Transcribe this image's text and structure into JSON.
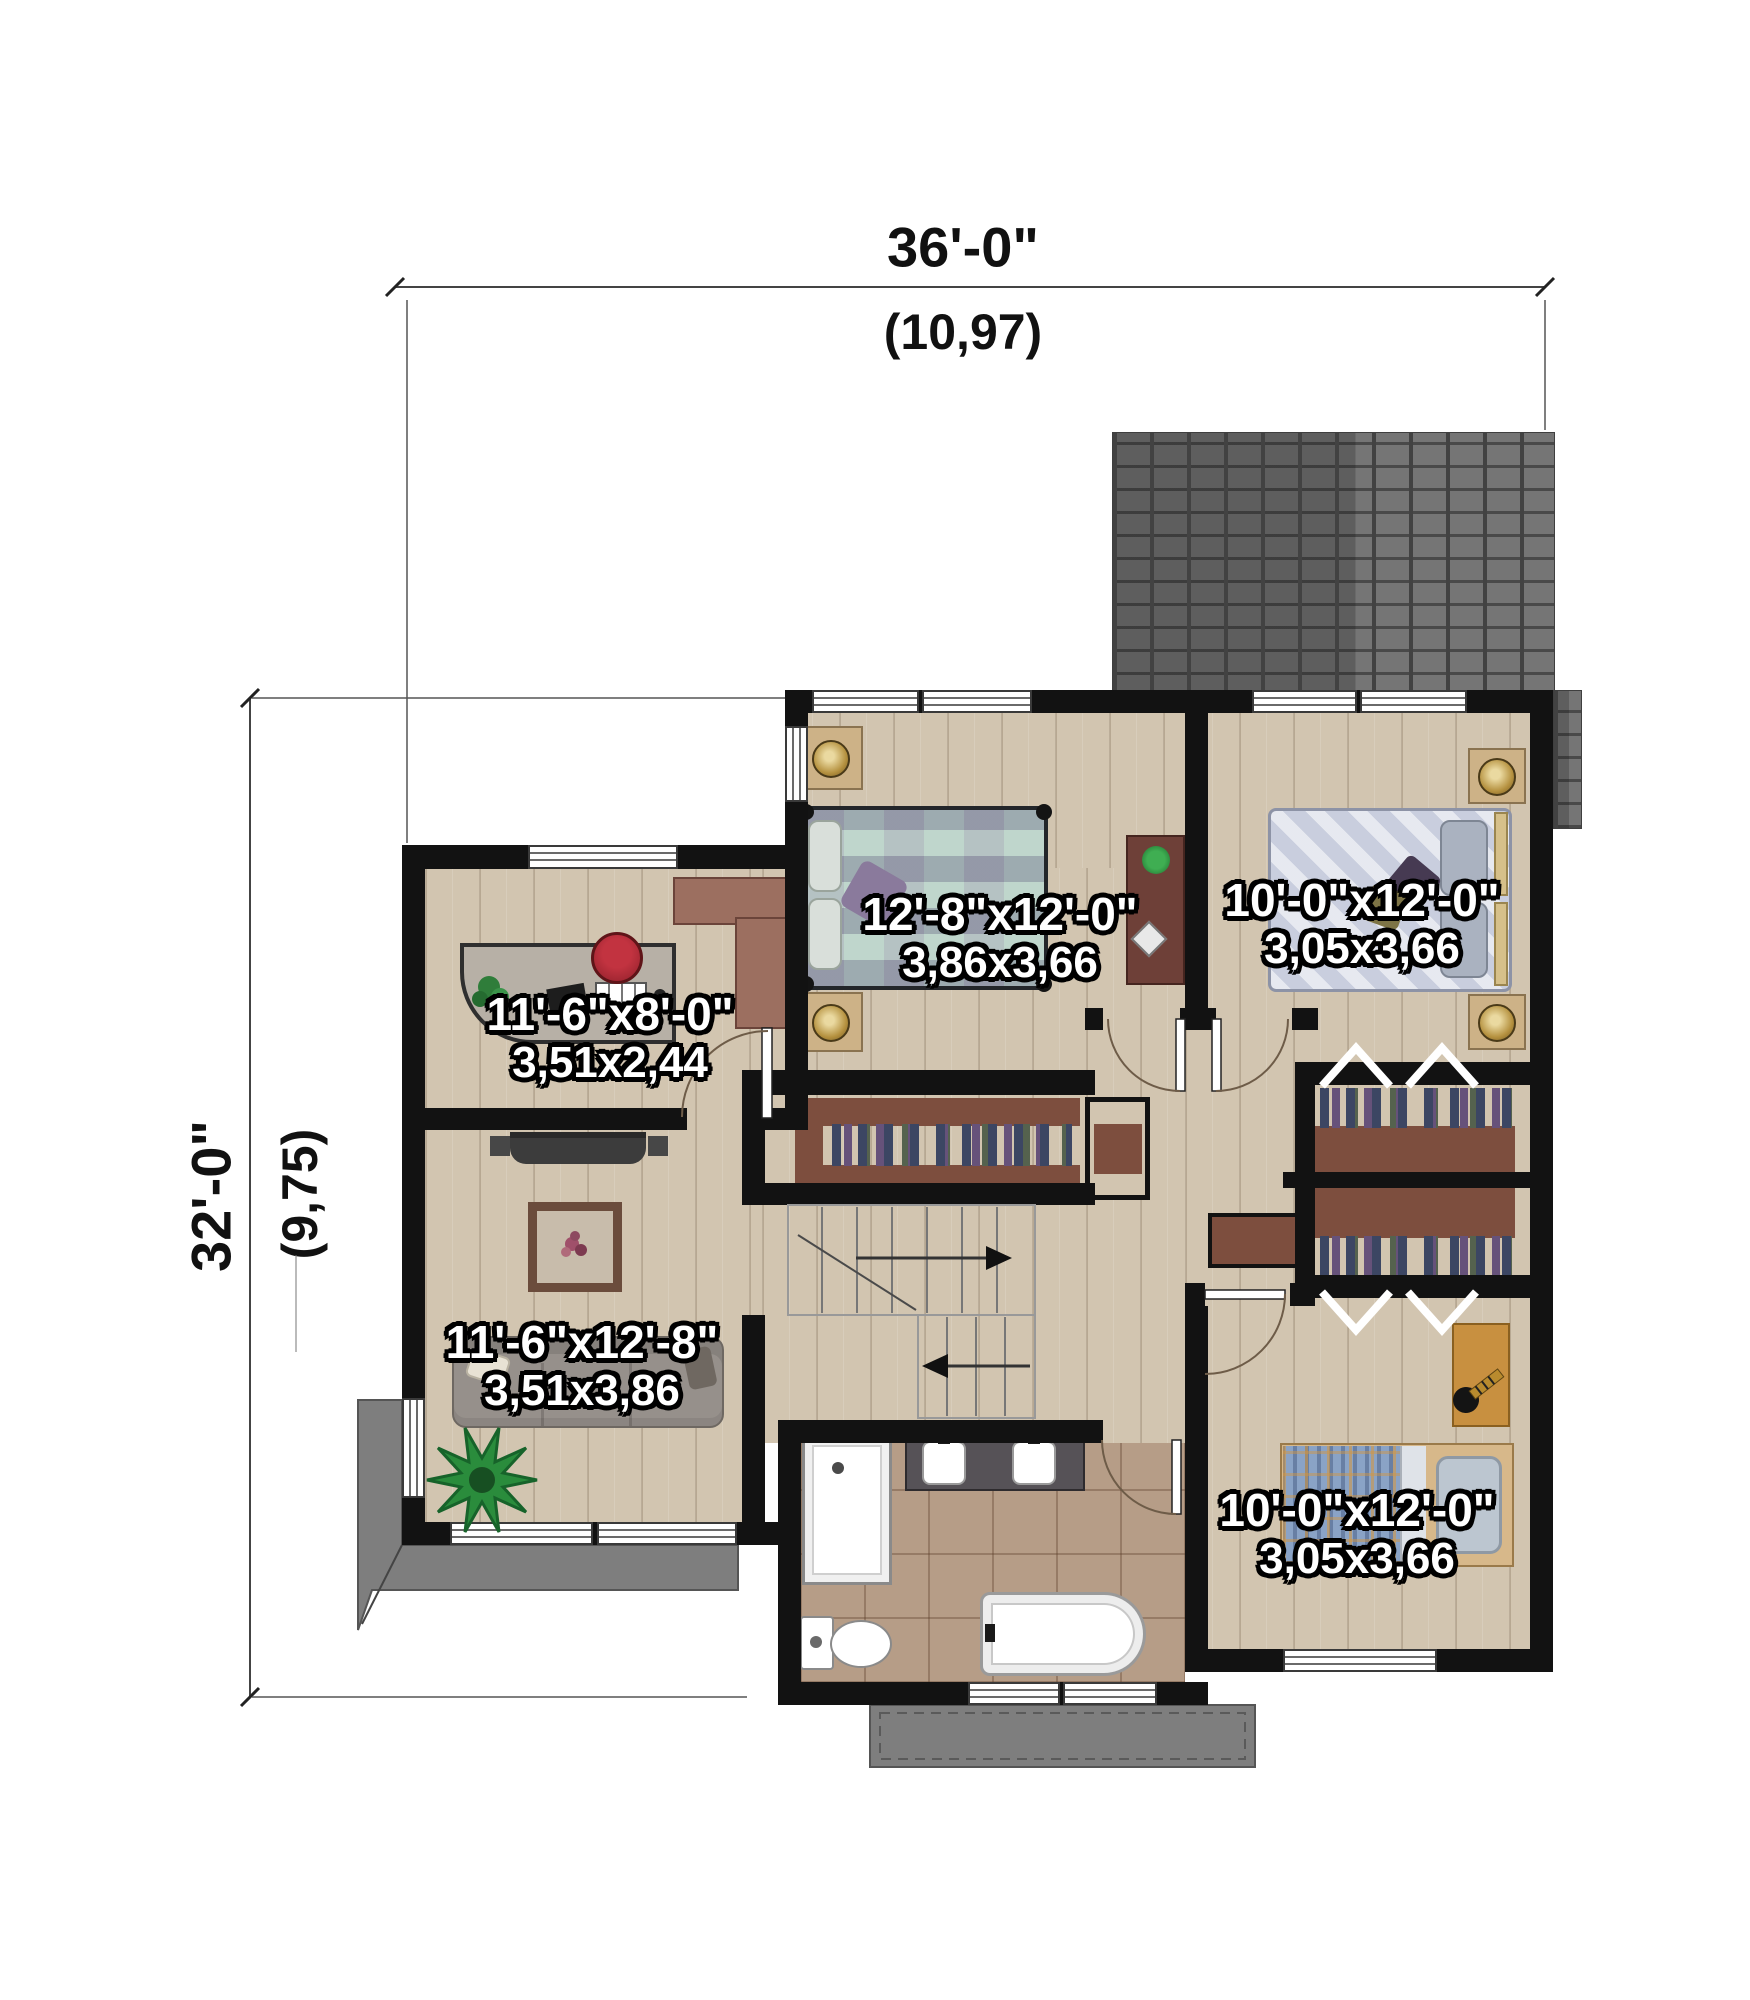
{
  "dimensions": {
    "top_feet": "36'-0\"",
    "top_meters": "(10,97)",
    "left_feet": "32'-0\"",
    "left_meters": "(9,75)"
  },
  "rooms": [
    {
      "name": "master-bedroom",
      "imperial": "12'-8\"x12'-0\"",
      "metric": "3,86x3,66"
    },
    {
      "name": "bedroom-top-right",
      "imperial": "10'-0\"x12'-0\"",
      "metric": "3,05x3,66"
    },
    {
      "name": "office-den",
      "imperial": "11'-6\"x8'-0\"",
      "metric": "3,51x2,44"
    },
    {
      "name": "living-room",
      "imperial": "11'-6\"x12'-8\"",
      "metric": "3,51x3,86"
    },
    {
      "name": "bedroom-bottom-right",
      "imperial": "10'-0\"x12'-0\"",
      "metric": "3,05x3,66"
    }
  ],
  "colors": {
    "wall": "#121212",
    "wood_floor": "#d2c5b0",
    "tile_floor": "#b69d87",
    "roof": "#6b6b6b",
    "porch": "#7e7e7e",
    "closet_shelf": "#7d4e3e",
    "label_text": "#ffffff"
  }
}
